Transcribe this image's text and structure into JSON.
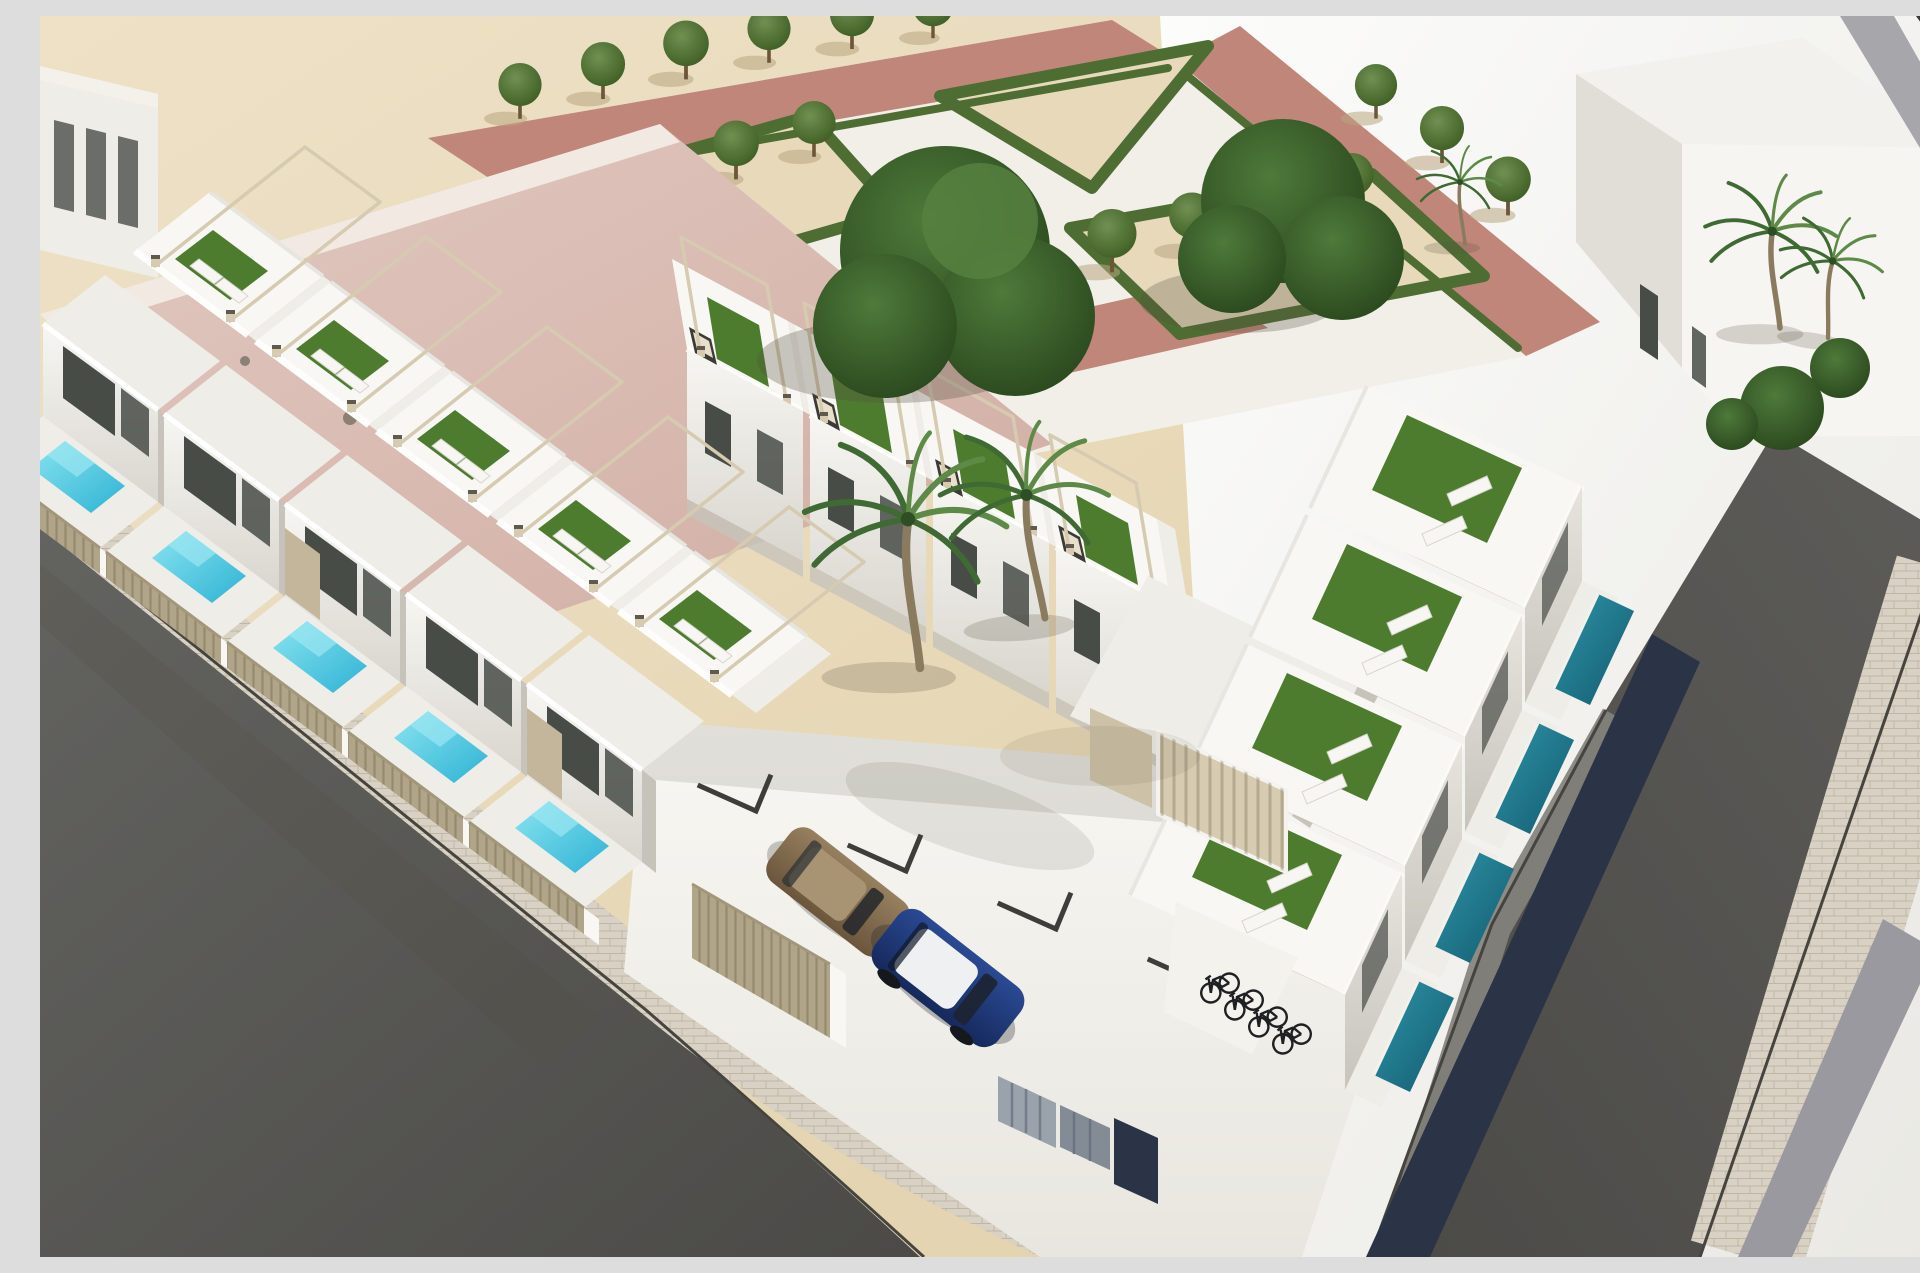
{
  "scene": {
    "type": "3d-architectural-render",
    "description": "Aerial 3D architectural rendering of a modern white residential complex on a corner plot: three rows of flat-roofed townhouses with rooftop terraces (artificial turf, sun loungers, thin pergola frames), private plunge pools behind beige slatted fences, a central white parking courtyard with a blue car, a bronze car, parked bicycles and tall palm trees. A sandy public park with triangular clipped hedges, rows of small trees and pink footpaths lies to the north, a pink-roofed neighbouring building to the north-west, a large blank white building and bright plaza to the north-east, and two grey asphalt streets with paver sidewalks meet at the bottom corner.",
    "counts": {
      "residential_units": 13,
      "rooftop_terraces": 13,
      "private_pools": 9,
      "cars": 2,
      "bicycles": 4,
      "palm_trees": 5,
      "park_trees": 17,
      "large_trees": 2
    },
    "vehicles": {
      "car_1": "blue hatchback with white roof",
      "car_2": "bronze sedan"
    }
  },
  "colors": {
    "sand": "#e7d9ba",
    "sand-light": "#eee1c6",
    "sand-dark": "#e0cfa9",
    "ground-shadow": "#b9a67f",
    "path-white": "#f1efe8",
    "path-pink": "#c08679",
    "hedge": "#4e6d33",
    "turf": "#4d7c2e",
    "tree-light": "#6f9150",
    "tree-dark": "#39571f",
    "bigtree-light": "#4e7a3a",
    "bigtree-dark": "#233d18",
    "bldg-white": "#f8f7f4",
    "bldg-offwhite": "#efede8",
    "bldg-shade": "#dddbd4",
    "bldg-dark": "#c6c3bb",
    "glass": "#484c47",
    "beige-panel": "#c3b69a",
    "pergola": "#d6cab0",
    "cap-dark": "#5f594e",
    "fence-beige": "#b0a489",
    "fence-line": "#968a6e",
    "roof-pink-light": "#e2cac2",
    "roof-pink-dark": "#d0aca2",
    "asphalt-light": "#636360",
    "asphalt-dark": "#4b4a47",
    "paver": "#d8d1c4",
    "paver-line": "#bfb6a4",
    "curb": "#46443f",
    "walk-gray": "#83827c",
    "stripe-gray": "#9a99a0",
    "sidewalk-gray": "#a7a6ab",
    "corner-dark": "#36373c",
    "pool-cyan-light": "#8ae4f0",
    "pool-cyan-deep": "#2eb3d4",
    "pool-teal-light": "#2e95a8",
    "pool-teal-deep": "#135a6e",
    "navy": "#2b3446",
    "car-blue-light": "#2a4a93",
    "car-blue-dark": "#16295c",
    "car-roof-white": "#eef0f2",
    "car-brown-light": "#97805f",
    "car-brown-dark": "#6b563d",
    "bike": "#1f2023",
    "cabinet": "#9aa2ac",
    "cabinet-dark": "#838b95",
    "marker": "#3e3d3a",
    "soft-shadow": "#55503f",
    "palm-trunk": "#8a7a5e",
    "palm-green": "#3f6a33",
    "palm-green-light": "#5d8a46",
    "sofa": "#3c3b36",
    "cushion": "#e8e0cd"
  }
}
